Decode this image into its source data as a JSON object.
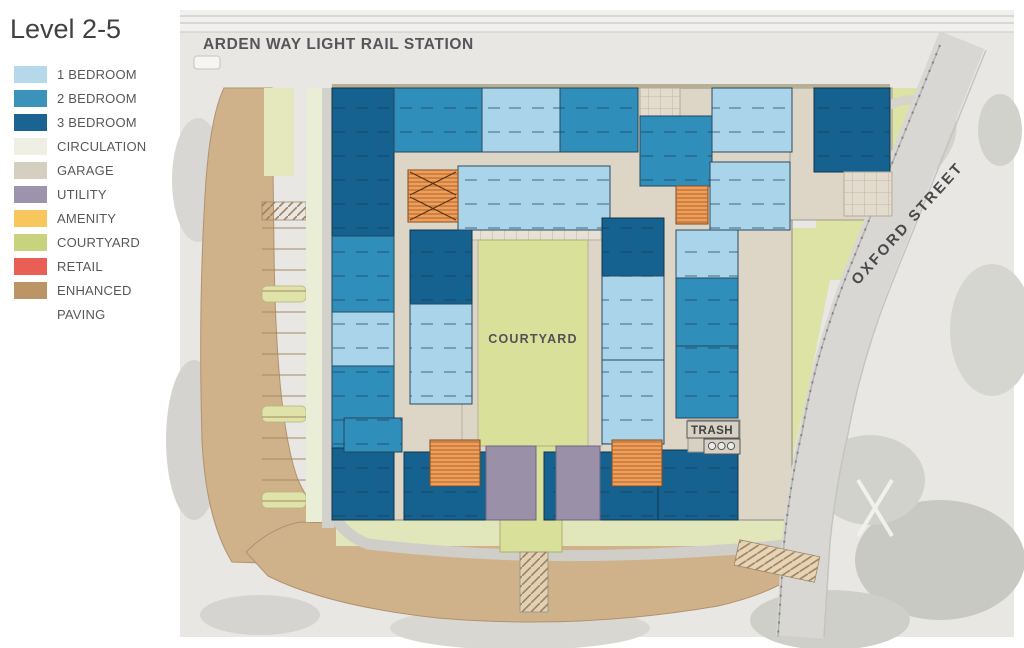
{
  "title": "Level 2-5",
  "legend": {
    "items": [
      {
        "key": "1-bedroom",
        "label": "1 BEDROOM",
        "color": "#b5d8ea"
      },
      {
        "key": "2-bedroom",
        "label": "2 BEDROOM",
        "color": "#3b93b9"
      },
      {
        "key": "3-bedroom",
        "label": "3 BEDROOM",
        "color": "#1b6390"
      },
      {
        "key": "circulation",
        "label": "CIRCULATION",
        "color": "#f0efe3"
      },
      {
        "key": "garage",
        "label": "GARAGE",
        "color": "#d5cfc2"
      },
      {
        "key": "utility",
        "label": "UTILITY",
        "color": "#9e93ad"
      },
      {
        "key": "amenity",
        "label": "AMENITY",
        "color": "#f7c65d"
      },
      {
        "key": "courtyard",
        "label": "COURTYARD",
        "color": "#c8d37e"
      },
      {
        "key": "retail",
        "label": "RETAIL",
        "color": "#ea5f55"
      },
      {
        "key": "enhanced-paving",
        "label": "ENHANCED PAVING",
        "color": "#bb9566"
      }
    ]
  },
  "labels": {
    "station": "ARDEN WAY LIGHT RAIL STATION",
    "street": "OXFORD STREET",
    "courtyard": "COURTYARD",
    "trash": "TRASH"
  },
  "plan": {
    "unit_fills": {
      "1br": "#a9d4e9",
      "2br": "#2f8fba",
      "3br": "#15618f",
      "stair": "#f09e58",
      "util": "#9a90a7",
      "circ": "#eaeed6",
      "walk": "#d2d1cb",
      "green": "#d9e09a",
      "cream": "#ddd6c6",
      "cream2": "#e6e1d5",
      "garage": "#e3dbcd",
      "garagep": "#d6d1c3"
    },
    "blocks": [
      {
        "t": "circ",
        "x": 306,
        "y": 88,
        "w": 16,
        "h": 434
      },
      {
        "t": "walk",
        "x": 322,
        "y": 88,
        "w": 12,
        "h": 440
      },
      {
        "t": "cream2",
        "x": 464,
        "y": 228,
        "w": 144,
        "h": 42
      },
      {
        "t": "green",
        "x": 478,
        "y": 240,
        "w": 110,
        "h": 206
      },
      {
        "t": "cream",
        "x": 462,
        "y": 240,
        "w": 16,
        "h": 206
      },
      {
        "t": "cream",
        "x": 588,
        "y": 240,
        "w": 14,
        "h": 206
      },
      {
        "t": "green",
        "x": 500,
        "y": 446,
        "w": 62,
        "h": 106
      },
      {
        "t": "3br",
        "x": 332,
        "y": 88,
        "w": 62,
        "h": 148
      },
      {
        "t": "2br",
        "x": 332,
        "y": 236,
        "w": 62,
        "h": 76
      },
      {
        "t": "1br",
        "x": 332,
        "y": 312,
        "w": 62,
        "h": 54
      },
      {
        "t": "2br",
        "x": 332,
        "y": 366,
        "w": 62,
        "h": 82
      },
      {
        "t": "3br",
        "x": 332,
        "y": 448,
        "w": 62,
        "h": 72
      },
      {
        "t": "3br",
        "x": 410,
        "y": 230,
        "w": 62,
        "h": 74
      },
      {
        "t": "1br",
        "x": 410,
        "y": 304,
        "w": 62,
        "h": 100
      },
      {
        "t": "2br",
        "x": 394,
        "y": 88,
        "w": 88,
        "h": 64
      },
      {
        "t": "1br",
        "x": 482,
        "y": 88,
        "w": 78,
        "h": 64
      },
      {
        "t": "2br",
        "x": 560,
        "y": 88,
        "w": 78,
        "h": 64
      },
      {
        "t": "garage",
        "x": 640,
        "y": 88,
        "w": 40,
        "h": 28
      },
      {
        "t": "2br",
        "x": 640,
        "y": 116,
        "w": 72,
        "h": 70
      },
      {
        "t": "1br",
        "x": 712,
        "y": 88,
        "w": 80,
        "h": 64
      },
      {
        "t": "3br",
        "x": 814,
        "y": 88,
        "w": 76,
        "h": 84
      },
      {
        "t": "garage",
        "x": 844,
        "y": 172,
        "w": 48,
        "h": 44
      },
      {
        "t": "1br",
        "x": 458,
        "y": 166,
        "w": 152,
        "h": 64
      },
      {
        "t": "stair",
        "x": 408,
        "y": 170,
        "w": 50,
        "h": 52
      },
      {
        "t": "stair",
        "x": 676,
        "y": 186,
        "w": 32,
        "h": 38
      },
      {
        "t": "1br",
        "x": 710,
        "y": 162,
        "w": 80,
        "h": 68
      },
      {
        "t": "3br",
        "x": 602,
        "y": 218,
        "w": 62,
        "h": 58
      },
      {
        "t": "1br",
        "x": 602,
        "y": 276,
        "w": 62,
        "h": 84
      },
      {
        "t": "1br",
        "x": 602,
        "y": 360,
        "w": 62,
        "h": 84
      },
      {
        "t": "1br",
        "x": 676,
        "y": 230,
        "w": 62,
        "h": 48
      },
      {
        "t": "2br",
        "x": 676,
        "y": 278,
        "w": 62,
        "h": 68
      },
      {
        "t": "2br",
        "x": 676,
        "y": 346,
        "w": 62,
        "h": 72
      },
      {
        "t": "2br",
        "x": 344,
        "y": 418,
        "w": 58,
        "h": 34
      },
      {
        "t": "3br",
        "x": 404,
        "y": 452,
        "w": 118,
        "h": 68
      },
      {
        "t": "3br",
        "x": 544,
        "y": 452,
        "w": 114,
        "h": 68
      },
      {
        "t": "3br",
        "x": 658,
        "y": 450,
        "w": 80,
        "h": 70
      },
      {
        "t": "util",
        "x": 486,
        "y": 446,
        "w": 50,
        "h": 74
      },
      {
        "t": "util",
        "x": 556,
        "y": 446,
        "w": 44,
        "h": 74
      },
      {
        "t": "stair",
        "x": 430,
        "y": 440,
        "w": 50,
        "h": 46
      },
      {
        "t": "stair",
        "x": 612,
        "y": 440,
        "w": 50,
        "h": 46
      },
      {
        "t": "garagep",
        "x": 688,
        "y": 420,
        "w": 52,
        "h": 32
      }
    ]
  }
}
